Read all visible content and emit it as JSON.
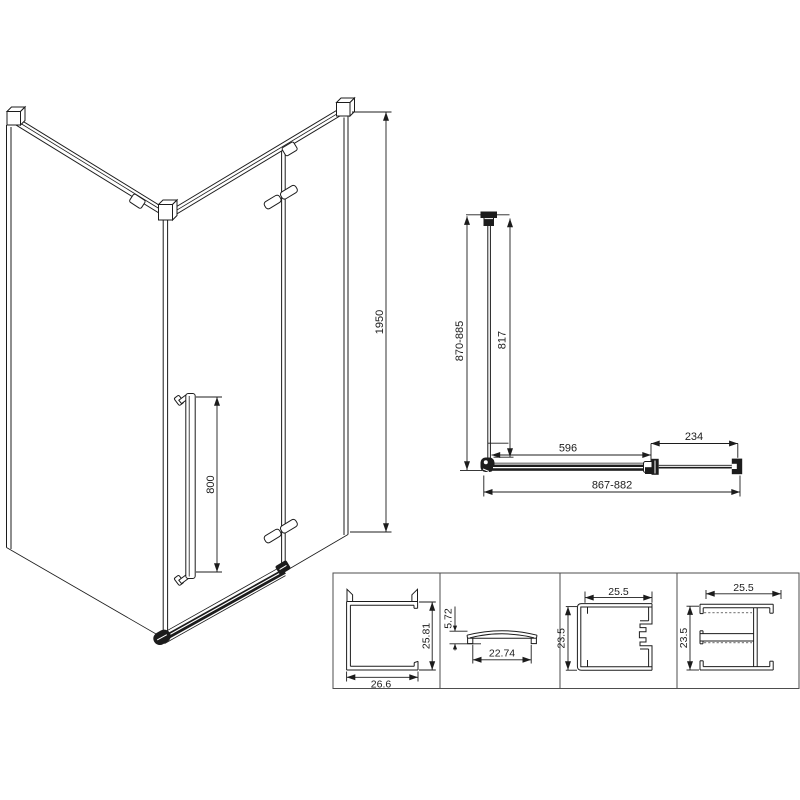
{
  "isometric": {
    "height": "1950",
    "handle_height": "800"
  },
  "plan": {
    "depth_overall": "870-885",
    "depth_glass": "817",
    "fixed_panel": "596",
    "door_panel": "234",
    "width_overall": "867-882"
  },
  "profiles": {
    "p1": {
      "width": "26.6",
      "height": "25.81"
    },
    "p2": {
      "height": "5.72",
      "width": "22.74"
    },
    "p3": {
      "width": "25.5",
      "height": "23.5"
    },
    "p4": {
      "width": "25.5",
      "height": "23.5"
    }
  }
}
